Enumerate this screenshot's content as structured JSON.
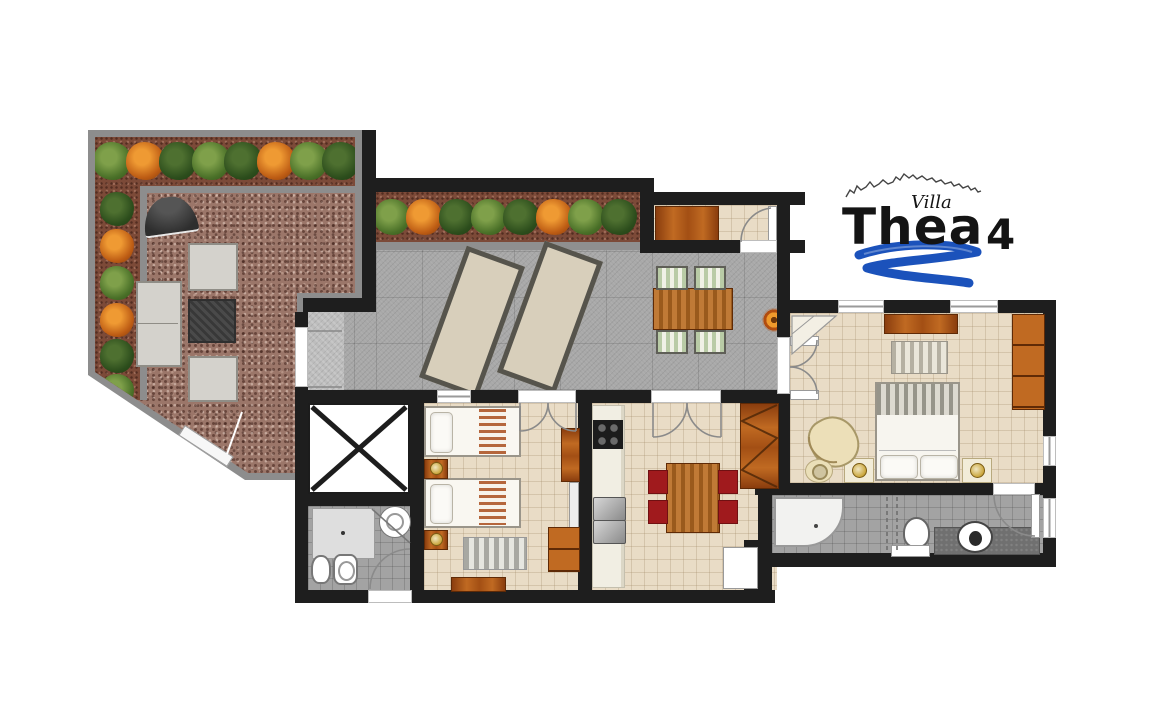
{
  "logo": {
    "villa": "Villa",
    "name": "Thea",
    "number": "4"
  },
  "palette": {
    "wall": "#1e1e1e",
    "terrace_floor": "#a8a8a8",
    "interior_floor": "#e9dcc6",
    "bathroom_floor": "#a3a3a3",
    "garden_gravel": "#9b7669",
    "garden_soil": "#7c4a38",
    "path_gray": "#8d8d8d",
    "wood": "#b05a1e",
    "chair_red": "#a01a1d",
    "logo_blue": "#1b52bb"
  },
  "rooms": [
    {
      "name": "garden-terrace",
      "items": [
        "tree-border",
        "gravel-yard",
        "awning",
        "garden-tables",
        "entrance-gate",
        "entrance-arrow"
      ]
    },
    {
      "name": "paved-sun-terrace",
      "items": [
        "sun-lounger",
        "sun-lounger",
        "outdoor-dining-table",
        "outdoor-chairs",
        "potted-plant",
        "planted-border"
      ]
    },
    {
      "name": "entry-hall",
      "items": [
        "sideboard",
        "entry-door"
      ]
    },
    {
      "name": "master-bedroom",
      "items": [
        "double-bed",
        "pillows",
        "nightstands",
        "lamps",
        "dresser",
        "wardrobe",
        "rug",
        "armchair",
        "side-table",
        "corner-shelf"
      ]
    },
    {
      "name": "twin-bedroom",
      "items": [
        "single-bed",
        "single-bed",
        "nightstands",
        "lamps",
        "rug",
        "wardrobe",
        "mirror",
        "bench"
      ]
    },
    {
      "name": "kitchen-dining",
      "items": [
        "kitchen-counter",
        "hob",
        "double-sink",
        "dining-table",
        "red-chairs",
        "hatched-wardrobe",
        "fridge"
      ]
    },
    {
      "name": "stairwell-void",
      "items": [
        "x-marker"
      ]
    },
    {
      "name": "shower-room",
      "items": [
        "shower-tray",
        "washbasin",
        "toilet",
        "bidet"
      ]
    },
    {
      "name": "main-bathroom",
      "items": [
        "corner-bathtub",
        "shower-screen",
        "toilet",
        "vanity-washbasin",
        "shelf"
      ]
    }
  ]
}
